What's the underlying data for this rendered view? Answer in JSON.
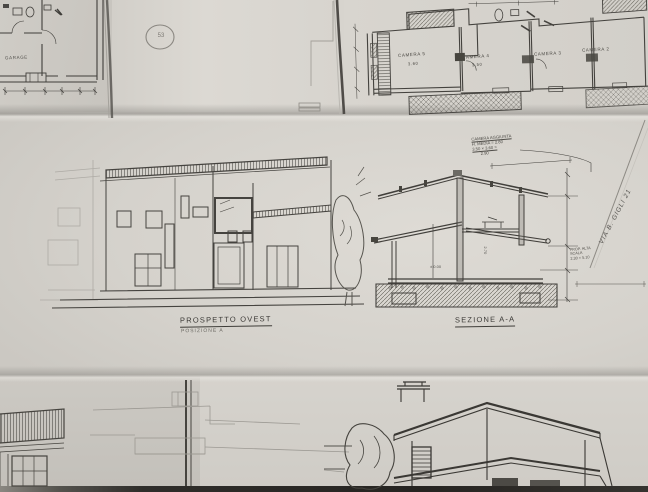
{
  "colors": {
    "paper_light": "#dbd8d2",
    "paper_mid": "#d4d1cb",
    "paper_dark": "#c8c5bf",
    "ink": "#3e3c38",
    "pencil": "#9a9791",
    "table_edge": "#2b2926"
  },
  "stamp": {
    "number": "53"
  },
  "plans": {
    "garage_label": "GARAGE",
    "rooms": [
      {
        "name": "CAMERA 5",
        "size": "3.60"
      },
      {
        "name": "CAMERA 4",
        "size": "3.50"
      },
      {
        "name": "CAMERA 3",
        "size": ""
      },
      {
        "name": "CAMERA 2",
        "size": ""
      }
    ]
  },
  "elevation": {
    "title": "PROSPETTO OVEST",
    "subtitle": "POSIZIONE A"
  },
  "section": {
    "title": "SEZIONE A-A",
    "note_lines": [
      "CAMERA AGGIUNTA",
      "H. MEDIA = 2.80",
      "3.50 × 3.60 =",
      "2.90"
    ],
    "height_dim": "2.70",
    "level_dim": "± 0.00"
  },
  "margin_notes": {
    "address": "VIA B. GIGLI 21",
    "lines": [
      "PROP. ALTA",
      "SCALA",
      "2.30 × 5.10"
    ]
  }
}
